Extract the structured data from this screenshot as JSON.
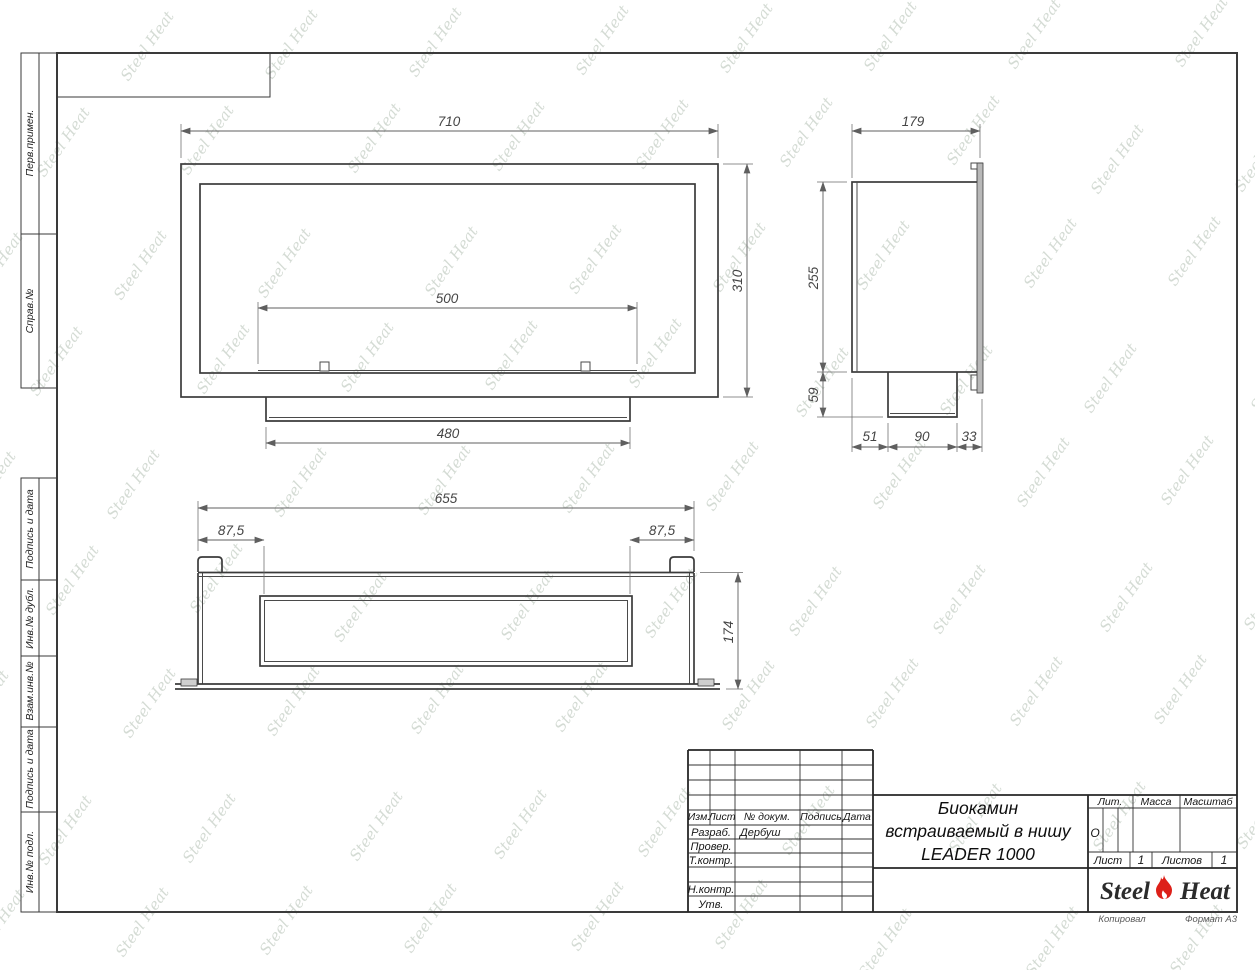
{
  "sheet": {
    "margin_labels": [
      "Перв.примен.",
      "Справ.№",
      "Подпись и дата",
      "Инв.№ дубл.",
      "Взам.инв.№",
      "Подпись и дата",
      "Инв.№ подл."
    ],
    "footer": {
      "left": "Копировал",
      "right": "Формат А3"
    }
  },
  "title_block": {
    "header_cols": {
      "izm": "Изм.",
      "list": "Лист",
      "ndoc": "№ докум.",
      "podpis": "Подпись",
      "data": "Дата"
    },
    "rows": {
      "razrab_label": "Разраб.",
      "razrab_value": "Дербуш",
      "prover_label": "Провер.",
      "tkontr_label": "Т.контр.",
      "nkontr_label": "Н.контр.",
      "utv_label": "Утв."
    },
    "title_lines": [
      "Биокамин",
      "встраиваемый в нишу",
      "LEADER 1000"
    ],
    "lit_label": "Лит.",
    "lit_value": "О",
    "massa_label": "Масса",
    "masshtab_label": "Масштаб",
    "list_label": "Лист",
    "list_value": "1",
    "listov_label": "Листов",
    "listov_value": "1",
    "logo": {
      "part1": "Steel",
      "part2": "Heat"
    }
  },
  "watermark": {
    "text": "Steel Heat"
  },
  "views": {
    "front": {
      "dims": [
        "710",
        "310",
        "500",
        "480"
      ]
    },
    "side": {
      "dims": [
        "179",
        "255",
        "59",
        "51",
        "90",
        "33"
      ]
    },
    "bottom": {
      "dims": [
        "655",
        "87,5",
        "87,5",
        "174"
      ]
    }
  },
  "colors": {
    "line": "#3b3b3b",
    "dim_line": "#5f5f5f",
    "flame_red": "#dd2019",
    "watermark": "#94a494"
  }
}
